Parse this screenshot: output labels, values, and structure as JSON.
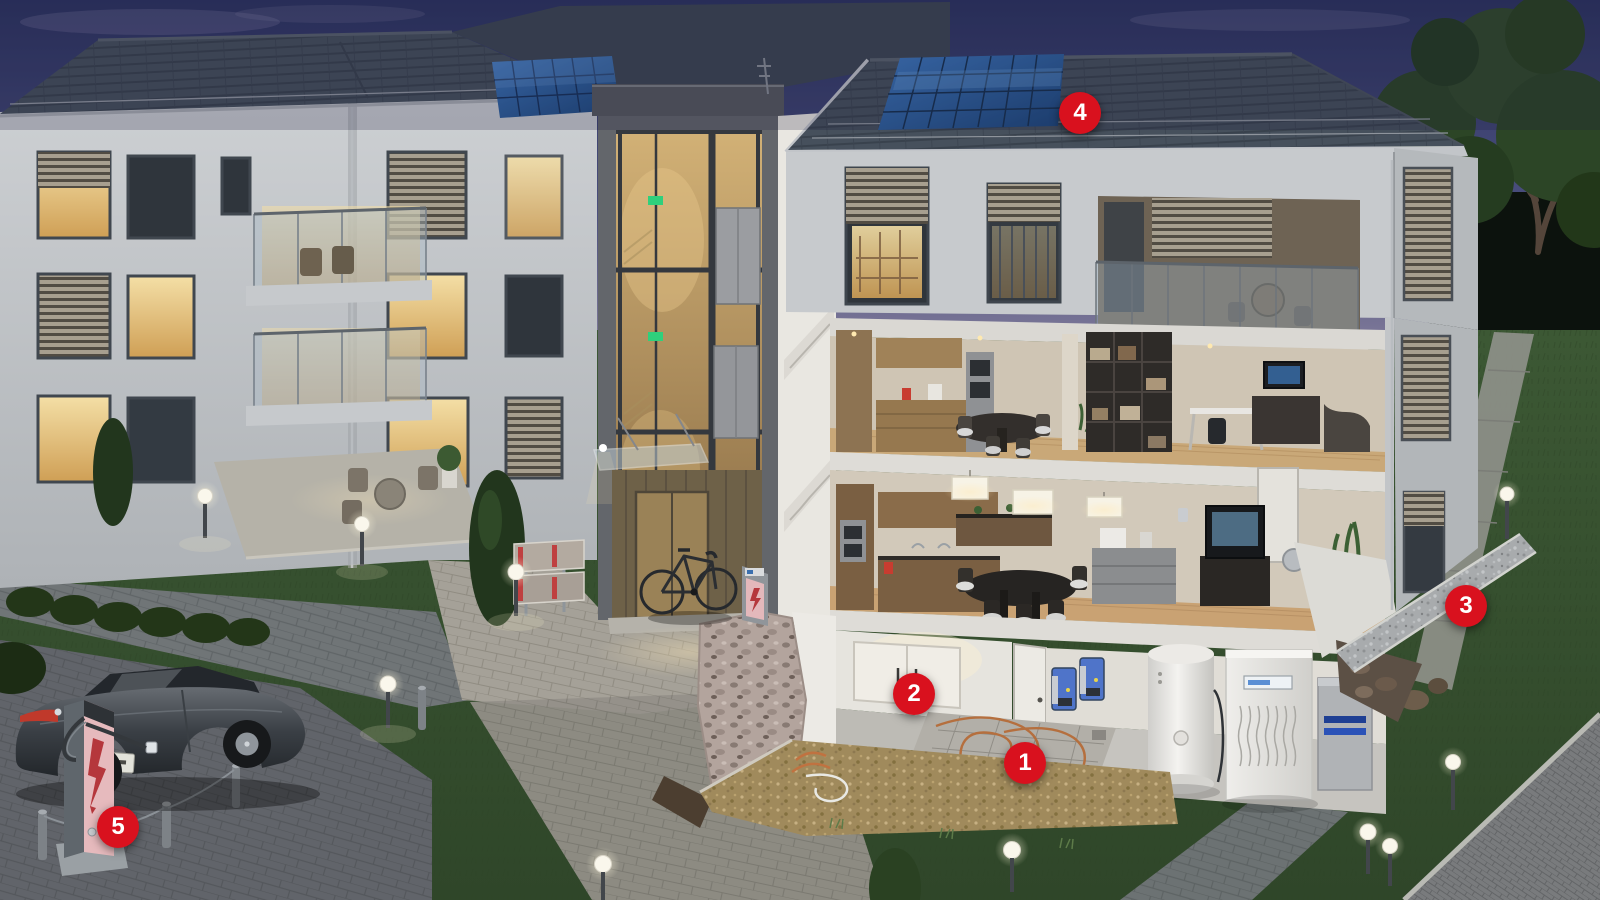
{
  "markers": [
    {
      "label": "1",
      "x": 1025,
      "y": 763
    },
    {
      "label": "2",
      "x": 914,
      "y": 694
    },
    {
      "label": "3",
      "x": 1466,
      "y": 606
    },
    {
      "label": "4",
      "x": 1080,
      "y": 113
    },
    {
      "label": "5",
      "x": 118,
      "y": 827
    }
  ],
  "colors": {
    "marker_red": "#d9111e",
    "marker_text": "#ffffff",
    "sky_top": "#2c3360",
    "sky_horizon": "#8b84a0",
    "roof_slate": "#46505c",
    "facade_grey": "#c7cacd",
    "tower_grey": "#63666b",
    "solar_blue": "#2a62a8",
    "warm_window": "#ecc57f",
    "grass_dusk": "#46643c",
    "path_grey": "#8f918b",
    "plaza_warm": "#a5a198",
    "parking_grey": "#6e7276",
    "gravel_tan": "#a08a5c",
    "charger_pink": "#e6babd",
    "charger_bolt": "#b5373c",
    "inverter_blue": "#4f74c9",
    "tank_white": "#f2f1ee",
    "exit_green": "#2fd07c",
    "tree_green": "#2c4526",
    "car_grey": "#3a3f45",
    "taillight_red": "#c0392b"
  },
  "icons": {
    "ev_charger_panel": "lightning-bolt-icon",
    "ebike_charger_panel": "lightning-bolt-icon",
    "stairwell_signs": "exit-sign-icon",
    "path_lights": "globe-lamp-icon"
  }
}
